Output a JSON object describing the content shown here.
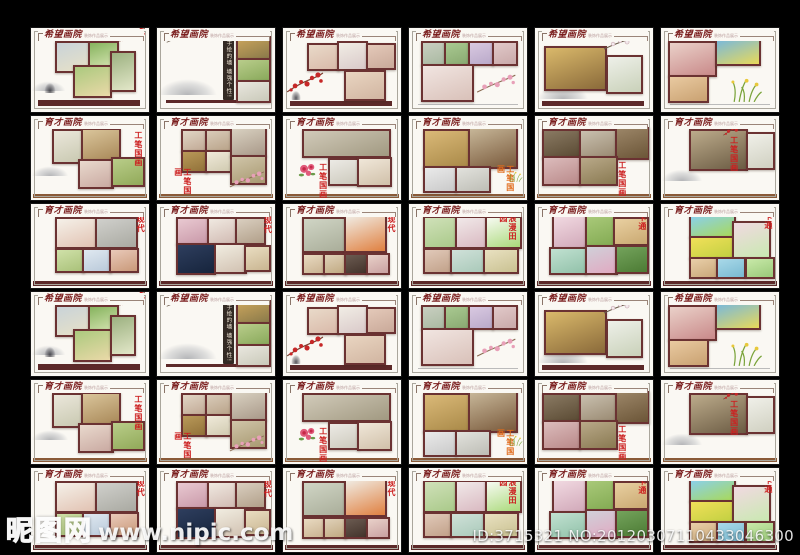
{
  "watermark": {
    "logo_text": "昵图网",
    "url_text": "www.nipic.com",
    "id_text": "ID:3715321 NO:20120307110433046300"
  },
  "grid": {
    "rows": 6,
    "cols": 6,
    "unique_rows": 3,
    "subtitle": "装饰作品展示",
    "cards": [
      {
        "title": "希望画院",
        "blocks": [
          [
            20,
            16,
            27,
            33,
            "#c9d3d9",
            "#e7e1c7",
            1
          ],
          [
            48,
            16,
            23,
            30,
            "#86b35e",
            "#dce8b8",
            1
          ],
          [
            36,
            44,
            29,
            35,
            "#abc97e",
            "#ead9a8",
            1
          ],
          [
            67,
            27,
            19,
            45,
            "#9cb180",
            "#e3e7c9",
            1
          ]
        ],
        "bar": [
          6,
          86,
          86,
          7,
          "#5c2929"
        ],
        "decor": [
          [
            "blossom",
            74,
            -2,
            24
          ],
          [
            "ink",
            0,
            62,
            30
          ],
          [
            "rock",
            10,
            64,
            12
          ]
        ]
      },
      {
        "title": "希望画院",
        "panel": {
          "text": "手绘的墙 墙强个性!",
          "l": 56,
          "t": 12,
          "w": 9,
          "h": 74
        },
        "blocks": [
          [
            67,
            10,
            26,
            23,
            "#caa45c",
            "#8a7a4a",
            1
          ],
          [
            67,
            36,
            26,
            23,
            "#b9cd8b",
            "#89a95b",
            1
          ],
          [
            67,
            62,
            26,
            23,
            "#e9e7df",
            "#c9c9b9",
            1
          ]
        ],
        "bar": [
          8,
          86,
          84,
          3,
          "#5c2929"
        ],
        "decor": [
          [
            "branch",
            8,
            4,
            24
          ],
          [
            "ink",
            0,
            58,
            52
          ]
        ]
      },
      {
        "title": "希望画院",
        "blocks": [
          [
            20,
            18,
            25,
            29,
            "#e9dac9",
            "#d9b9a9",
            1
          ],
          [
            46,
            16,
            23,
            31,
            "#f1ede5",
            "#d9c9c9",
            1
          ],
          [
            70,
            18,
            22,
            27,
            "#e4c9b9",
            "#c9a999",
            1
          ],
          [
            52,
            50,
            32,
            32,
            "#e9d5c1",
            "#d1b5a1",
            1
          ]
        ],
        "bar": [
          6,
          87,
          86,
          6,
          "#5c2929"
        ],
        "decor": [
          [
            "blossom",
            2,
            50,
            34
          ],
          [
            "rock",
            6,
            74,
            10
          ]
        ]
      },
      {
        "title": "希望画院",
        "blocks": [
          [
            10,
            15,
            19,
            25,
            "#c9cfc1",
            "#a9b9a1",
            1
          ],
          [
            30,
            15,
            19,
            25,
            "#a9c991",
            "#89a971",
            1
          ],
          [
            50,
            15,
            19,
            25,
            "#d9c9e1",
            "#b9a9c9",
            1
          ],
          [
            70,
            15,
            19,
            25,
            "#e1c9c9",
            "#c9a9a9",
            1
          ],
          [
            10,
            43,
            42,
            40,
            "#f1e5e1",
            "#d9c1b9",
            1
          ]
        ],
        "bar": [
          8,
          90,
          84,
          2,
          "#bbbbbb"
        ],
        "decor": [
          [
            "pinkbranch",
            56,
            54,
            36
          ]
        ]
      },
      {
        "title": "希望画院",
        "blocks": [
          [
            8,
            22,
            50,
            48,
            "#dab96b",
            "#8a6a3a",
            1
          ],
          [
            60,
            32,
            28,
            42,
            "#eef0e9",
            "#c9d1b9",
            1
          ]
        ],
        "bar": [
          6,
          87,
          86,
          6,
          "#5c2929"
        ],
        "decor": [
          [
            "branch",
            58,
            6,
            34
          ],
          [
            "ink",
            2,
            66,
            44
          ]
        ]
      },
      {
        "title": "希望画院",
        "blocks": [
          [
            6,
            15,
            38,
            38,
            "#ead1c9",
            "#c98989",
            1
          ],
          [
            6,
            56,
            31,
            28,
            "#e9caa1",
            "#c9a171",
            1
          ],
          [
            46,
            13,
            35,
            27,
            "#7bb9d9",
            "#e9d959",
            1
          ]
        ],
        "bar": [
          8,
          90,
          84,
          2,
          "#bbbbbb"
        ],
        "decor": [
          [
            "grass",
            58,
            58,
            32
          ]
        ]
      },
      {
        "title": "育才画院",
        "label": {
          "text": "工笔国画",
          "l": 87,
          "t": 18
        },
        "blocks": [
          [
            18,
            15,
            23,
            37,
            "#ebe7db",
            "#c9c9b1",
            1
          ],
          [
            42,
            14,
            31,
            35,
            "#dac59b",
            "#a98959",
            1
          ],
          [
            40,
            51,
            27,
            31,
            "#e9d9cd",
            "#c9a9a1",
            1
          ],
          [
            68,
            49,
            25,
            31,
            "#b9cd89",
            "#91a959",
            1
          ]
        ],
        "bar": [
          2,
          93,
          96,
          5,
          "#8a5a38"
        ],
        "decor": [
          [
            "ink",
            0,
            58,
            32
          ]
        ]
      },
      {
        "title": "育才画院",
        "label": {
          "text": "工笔国画",
          "l": 14,
          "t": 62
        },
        "blocks": [
          [
            20,
            15,
            20,
            23,
            "#e1d5c5",
            "#c1a995",
            1
          ],
          [
            41,
            15,
            20,
            23,
            "#d9cbb9",
            "#b9a389",
            1
          ],
          [
            20,
            40,
            20,
            23,
            "#b99959",
            "#917139",
            1
          ],
          [
            41,
            40,
            20,
            23,
            "#f0eada",
            "#d0cab0",
            1
          ],
          [
            62,
            13,
            28,
            31,
            "#d9d1c1",
            "#a99989",
            1
          ],
          [
            62,
            46,
            28,
            31,
            "#d0c5a9",
            "#a89971",
            1
          ]
        ],
        "bar": [
          2,
          93,
          96,
          5,
          "#8a5a38"
        ],
        "decor": [
          [
            "pinkbranch",
            60,
            64,
            32
          ]
        ]
      },
      {
        "title": "育才画院",
        "label": {
          "text": "工笔国画",
          "l": 30,
          "t": 56
        },
        "blocks": [
          [
            16,
            15,
            72,
            30,
            "#d1cab9",
            "#a19981",
            1
          ],
          [
            38,
            50,
            24,
            28,
            "#eceae5",
            "#ccc9bc",
            1
          ],
          [
            63,
            49,
            26,
            31,
            "#f0e7d9",
            "#d0c0a9",
            1
          ]
        ],
        "bar": [
          2,
          93,
          96,
          5,
          "#8a5a38"
        ],
        "decor": [
          [
            "peony",
            12,
            52,
            18
          ]
        ]
      },
      {
        "title": "育才画院",
        "label": {
          "text": "工笔国画",
          "l": 74,
          "t": 58,
          "color": "#e06a1a"
        },
        "blocks": [
          [
            12,
            15,
            36,
            43,
            "#dab978",
            "#a98948",
            1
          ],
          [
            50,
            11,
            39,
            47,
            "#c9b99b",
            "#79593b",
            1
          ],
          [
            12,
            60,
            25,
            27,
            "#eaeaea",
            "#c9c9c9",
            1
          ],
          [
            39,
            60,
            27,
            27,
            "#e2e2dd",
            "#bdbdb5",
            1
          ]
        ],
        "bar": [
          2,
          93,
          96,
          5,
          "#8a5a38"
        ],
        "decor": [
          [
            "grass",
            84,
            66,
            14
          ]
        ]
      },
      {
        "title": "育才画院",
        "label": {
          "text": "工笔国画",
          "l": 70,
          "t": 54
        },
        "blocks": [
          [
            6,
            15,
            30,
            31,
            "#8a7a63",
            "#5a4a33",
            1
          ],
          [
            37,
            15,
            30,
            31,
            "#c9c0af",
            "#998971",
            1
          ],
          [
            68,
            13,
            26,
            35,
            "#9b8567",
            "#6b5537",
            1
          ],
          [
            6,
            48,
            30,
            31,
            "#dcbcbc",
            "#b98989",
            1
          ],
          [
            37,
            48,
            30,
            31,
            "#b9a989",
            "#897951",
            1
          ]
        ],
        "bar": [
          2,
          93,
          96,
          5,
          "#8a5a38"
        ],
        "decor": []
      },
      {
        "title": "育才画院",
        "label": {
          "text": "工笔国画",
          "l": 58,
          "t": 24
        },
        "blocks": [
          [
            24,
            15,
            46,
            46,
            "#bcab8b",
            "#6b5b43",
            1
          ],
          [
            72,
            19,
            21,
            41,
            "#f0f0e9",
            "#d0d0c1",
            1
          ]
        ],
        "bar": [
          2,
          93,
          96,
          5,
          "#8a5a38"
        ],
        "decor": [
          [
            "blossom",
            52,
            6,
            22
          ],
          [
            "ink",
            0,
            62,
            36
          ]
        ]
      },
      {
        "title": "育才画院",
        "label": {
          "text": "现代",
          "l": 89,
          "t": 13
        },
        "blocks": [
          [
            20,
            15,
            33,
            34,
            "#f5f1e9",
            "#e1c1b1",
            1
          ],
          [
            54,
            15,
            33,
            34,
            "#d0d0cc",
            "#a9a9a1",
            1
          ],
          [
            20,
            52,
            22,
            25,
            "#d0e1a9",
            "#a9c179",
            1
          ],
          [
            43,
            52,
            22,
            25,
            "#e0e9f1",
            "#b9c9d9",
            1
          ],
          [
            66,
            52,
            22,
            25,
            "#e9c9b9",
            "#c99979",
            1
          ]
        ],
        "bar": [
          2,
          92,
          96,
          6,
          "#5c2929"
        ],
        "decor": []
      },
      {
        "title": "育才画院",
        "label": {
          "text": "现代",
          "l": 90,
          "t": 14
        },
        "blocks": [
          [
            16,
            15,
            25,
            29,
            "#e9c9d1",
            "#c999a9",
            1
          ],
          [
            42,
            15,
            25,
            29,
            "#f0e9e1",
            "#d0b9b1",
            1
          ],
          [
            66,
            15,
            23,
            29,
            "#dacfc0",
            "#b19f89",
            1
          ],
          [
            16,
            47,
            31,
            33,
            "#2e3e5e",
            "#16243c",
            1
          ],
          [
            48,
            47,
            25,
            31,
            "#f1ede1",
            "#d1c1b1",
            1
          ],
          [
            74,
            49,
            19,
            27,
            "#e9ddc1",
            "#c9b591",
            1
          ]
        ],
        "bar": [
          2,
          92,
          96,
          6,
          "#5c2929"
        ],
        "decor": []
      },
      {
        "title": "育才画院",
        "label": {
          "text": "现代",
          "l": 88,
          "t": 13
        },
        "blocks": [
          [
            16,
            15,
            35,
            38,
            "#d0d5c5",
            "#a9ad99",
            1
          ],
          [
            52,
            13,
            33,
            40,
            "#f0eae1",
            "#e08040",
            1
          ],
          [
            16,
            58,
            17,
            22,
            "#e9dac1",
            "#c9b291",
            1
          ],
          [
            34,
            58,
            17,
            22,
            "#e0d1b9",
            "#c0a981",
            1
          ],
          [
            52,
            58,
            17,
            22,
            "#6b5b51",
            "#43332b",
            1
          ],
          [
            70,
            58,
            17,
            22,
            "#e9d1c9",
            "#c9a1a1",
            1
          ]
        ],
        "bar": [
          2,
          92,
          96,
          6,
          "#5c2929"
        ],
        "decor": []
      },
      {
        "title": "育才画院",
        "label": {
          "text": "浪漫田园",
          "l": 76,
          "t": 12,
          "h": 30
        },
        "blocks": [
          [
            12,
            14,
            26,
            35,
            "#d0e1b9",
            "#a9c989",
            1
          ],
          [
            39,
            14,
            24,
            35,
            "#f1e9e9",
            "#d9b9c1",
            1
          ],
          [
            64,
            14,
            28,
            35,
            "#f7faf2",
            "#a9d979",
            1
          ],
          [
            12,
            52,
            22,
            27,
            "#e1c9b9",
            "#c1a189",
            1
          ],
          [
            35,
            52,
            27,
            27,
            "#d0e1d9",
            "#a9c9b9",
            1
          ],
          [
            63,
            52,
            27,
            27,
            "#e9e1c1",
            "#c9c191",
            1
          ]
        ],
        "bar": [
          2,
          92,
          96,
          6,
          "#5c2929"
        ],
        "decor": []
      },
      {
        "title": "育才画院",
        "label": {
          "text": "卡通",
          "l": 87,
          "t": 11
        },
        "blocks": [
          [
            14,
            13,
            27,
            36,
            "#f1d9e1",
            "#d1a9b9",
            1
          ],
          [
            42,
            13,
            23,
            36,
            "#a9c979",
            "#81a951",
            1
          ],
          [
            66,
            15,
            27,
            30,
            "#e9d0a1",
            "#c9a871",
            1
          ],
          [
            12,
            51,
            29,
            29,
            "#c1e1d1",
            "#91c1a9",
            1
          ],
          [
            42,
            49,
            25,
            31,
            "#d0d0d9",
            "#e1a9c1",
            1
          ],
          [
            68,
            49,
            25,
            29,
            "#74a35c",
            "#4c7b34",
            1
          ]
        ],
        "bar": [
          2,
          92,
          96,
          6,
          "#5c2929"
        ],
        "decor": []
      },
      {
        "title": "育才画院",
        "label": {
          "text": "卡通",
          "l": 87,
          "t": 10
        },
        "blocks": [
          [
            24,
            13,
            36,
            23,
            "#8ad0e9",
            "#a9d959",
            1
          ],
          [
            24,
            38,
            36,
            23,
            "#f1e059",
            "#c1d041",
            1
          ],
          [
            60,
            20,
            30,
            41,
            "#f1d9e1",
            "#c9e9b1",
            1
          ],
          [
            24,
            63,
            21,
            22,
            "#e9cfa9",
            "#c9a779",
            1
          ],
          [
            47,
            63,
            22,
            22,
            "#a9d9e9",
            "#79b9d1",
            1
          ],
          [
            71,
            63,
            22,
            22,
            "#c9e9a9",
            "#99c979",
            1
          ]
        ],
        "bar": [
          2,
          92,
          96,
          6,
          "#5c2929"
        ],
        "decor": []
      }
    ]
  }
}
